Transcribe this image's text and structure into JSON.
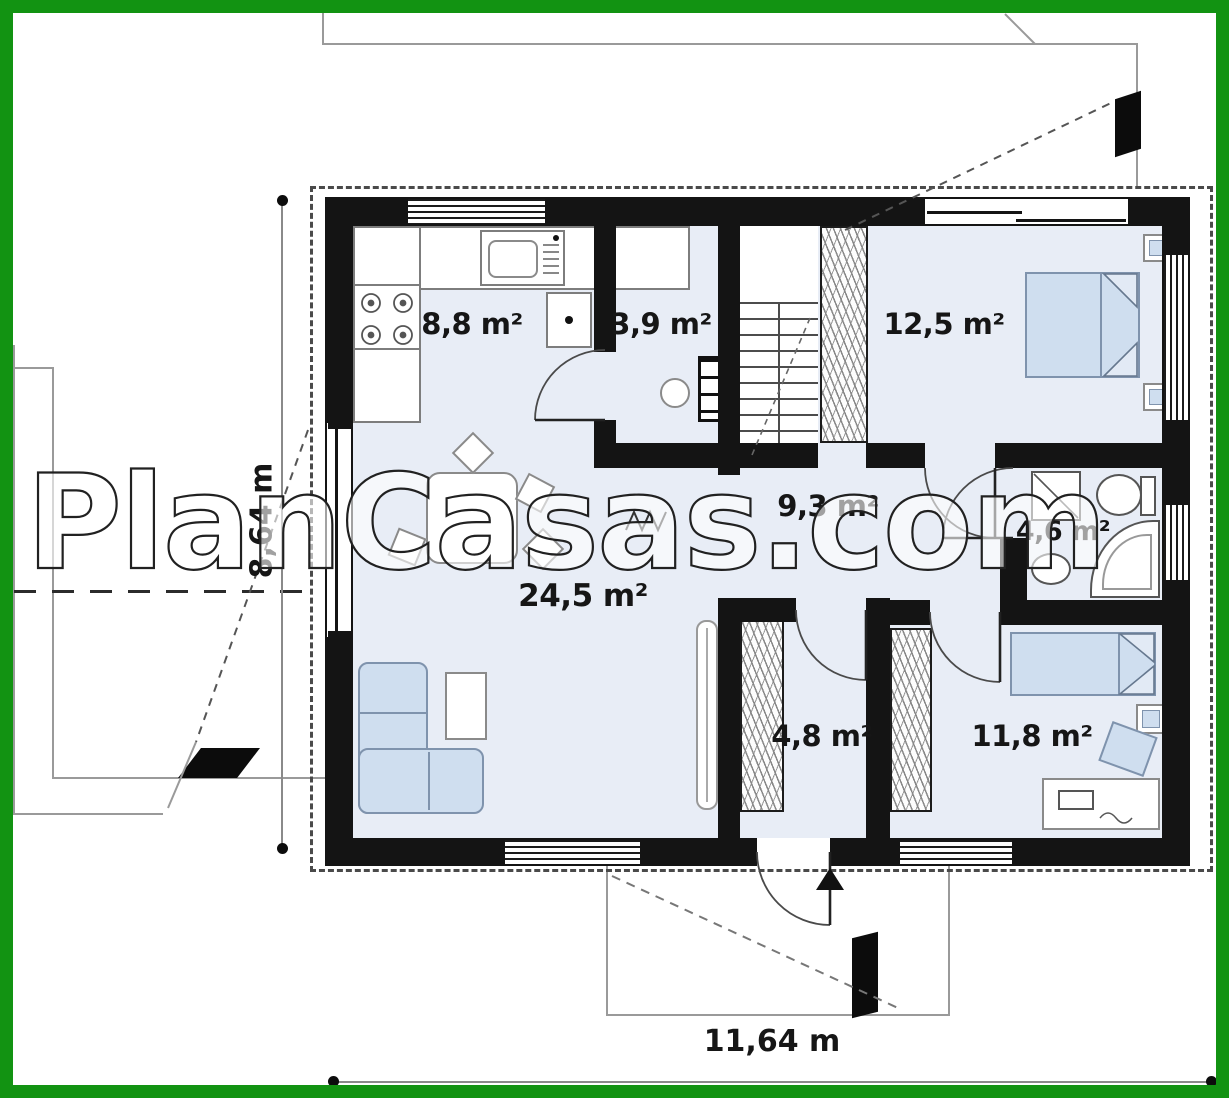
{
  "watermark": {
    "text": "PlanCasas.com"
  },
  "plan": {
    "rooms": [
      {
        "id": "kitchen",
        "area_label": "8,8 m²"
      },
      {
        "id": "pantry",
        "area_label": "3,9 m²"
      },
      {
        "id": "bedroom-1",
        "area_label": "12,5 m²"
      },
      {
        "id": "hall",
        "area_label": "9,3 m²"
      },
      {
        "id": "bathroom",
        "area_label": "4,6 m²"
      },
      {
        "id": "living-room",
        "area_label": "24,5 m²"
      },
      {
        "id": "entry",
        "area_label": "4,8 m²"
      },
      {
        "id": "bedroom-2",
        "area_label": "11,8 m²"
      }
    ],
    "dimensions": {
      "height_label": "8,64 m",
      "width_label": "11,64 m"
    }
  },
  "colors": {
    "frame_green": "#129312",
    "floor_blue": "#e8edf6",
    "furniture_blue": "#cfdeef",
    "wall_black": "#141414"
  }
}
